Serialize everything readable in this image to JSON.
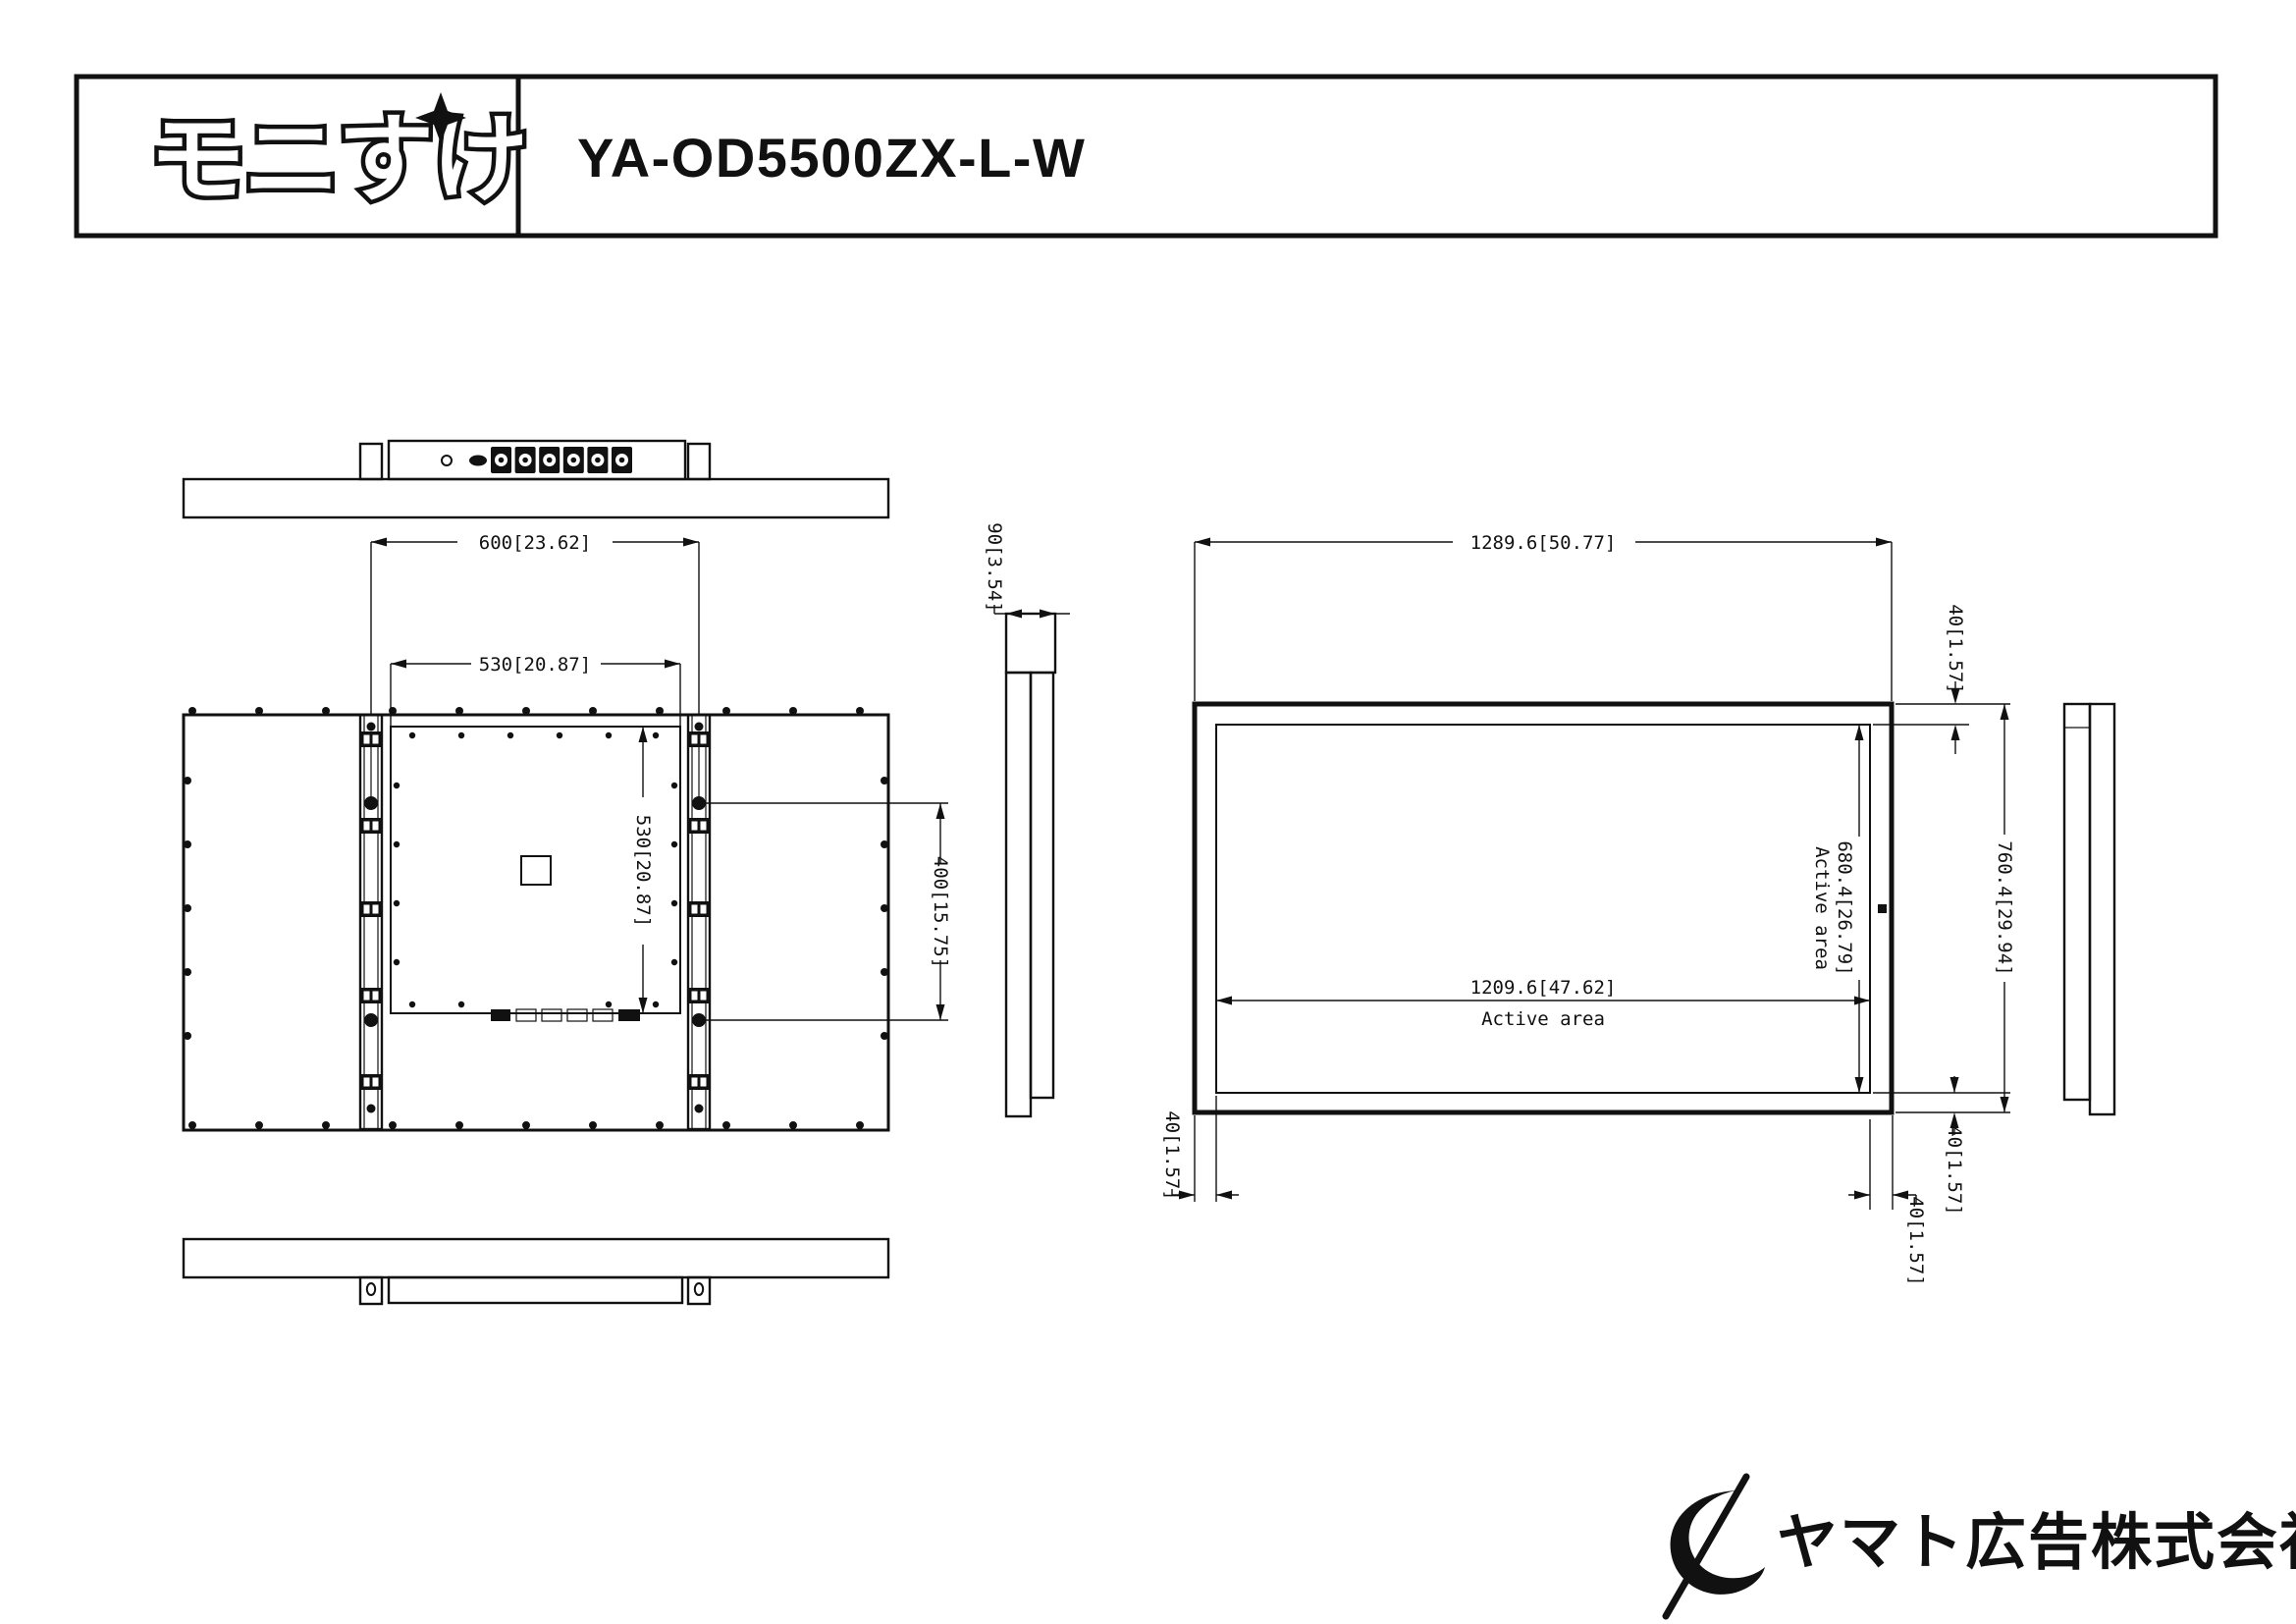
{
  "title_block": {
    "logo": "モニすけ",
    "model": "YA-OD5500ZX-L-W"
  },
  "views": {
    "front": {
      "overall_width": "1289.6[50.77]",
      "overall_height": "760.4[29.94]",
      "active_width": "1209.6[47.62]",
      "active_height": "680.4[26.79]",
      "active_area_label": "Active area",
      "bezel_top": "40[1.57]",
      "bezel_bottom": "40[1.57]",
      "bezel_left": "40[1.57]",
      "bezel_right": "40[1.57]"
    },
    "rear": {
      "mount_pitch_width": "600[23.62]",
      "plate_width": "530[20.87]",
      "plate_height": "530[20.87]",
      "mount_pitch_height": "400[15.75]"
    },
    "side": {
      "depth": "90[3.54]"
    }
  },
  "footer": {
    "company": "ヤマト広告株式会社"
  }
}
